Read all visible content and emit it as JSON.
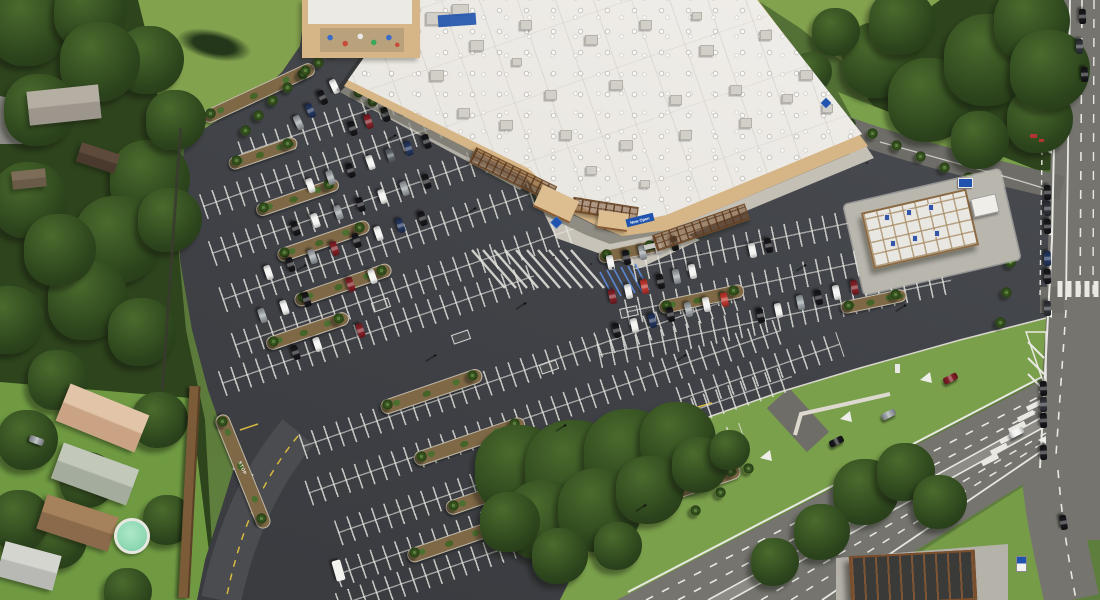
{
  "scene": {
    "type": "aerial-photograph",
    "description": "Oblique aerial view of a newly opened warehouse club store with tan walls and white roof, a large striped parking lot with palm landscaping, a fuel station canopy, arterial roads with turn lanes on two sides, preserved oak tree clusters, and an adjacent residential neighborhood behind a long wall."
  },
  "store": {
    "logo": "blue-diamond-logo",
    "banner": {
      "text": "Now Open",
      "background": "#2053ad",
      "text_color": "#ffffff"
    },
    "roof_color": "#edebe7",
    "wall_color": "#d6b586",
    "pergola_color": "#7d5634"
  },
  "road_markings": {
    "stop_text": "STOP",
    "lane_line_color": "#e8e8e2",
    "center_line_color": "#d8b93f"
  },
  "signs": {
    "entrance_monument_sign_color": "#2053ad",
    "outparcel_sign_color": "#2053ad"
  },
  "palette": {
    "asphalt": "#43464a",
    "road": "#75746f",
    "field": "#83a24e",
    "forest": "#2e441d",
    "grass": "#7aa04b",
    "mulch": "#7f6846",
    "concrete": "#c5c0b6",
    "pool": "#8fd9b4",
    "car_colors": [
      "#f2f2f0",
      "#17171b",
      "#9aa0a4",
      "#7e1f26",
      "#22345c",
      "#5a6066",
      "#b8352c",
      "#2e3136"
    ]
  }
}
